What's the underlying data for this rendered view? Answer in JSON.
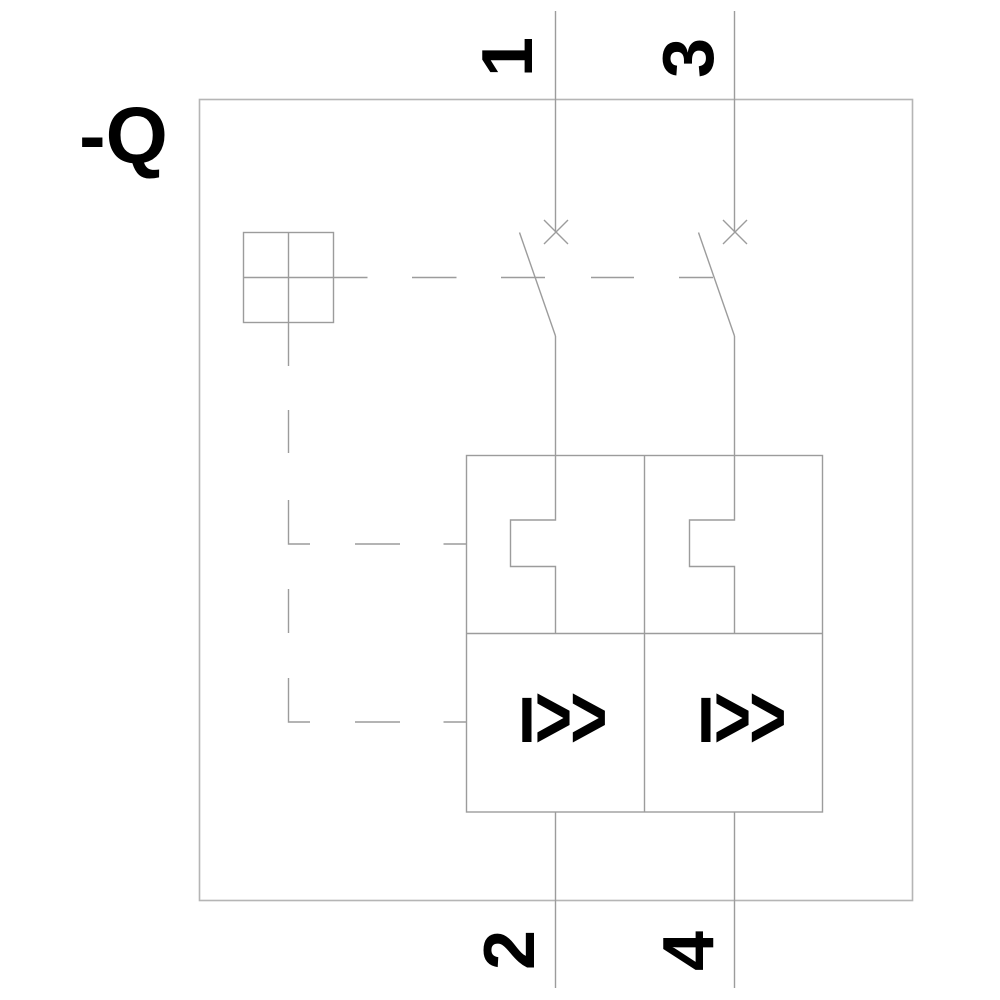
{
  "diagram": {
    "device_label": "-Q",
    "top_terminals": [
      {
        "label": "1"
      },
      {
        "label": "3"
      }
    ],
    "bottom_terminals": [
      {
        "label": "2"
      },
      {
        "label": "4"
      }
    ],
    "trip_units": [
      {
        "bar": "I",
        "chevrons": ">>"
      },
      {
        "bar": "I",
        "chevrons": ">>"
      }
    ],
    "colors": {
      "line": "#9c9c9c",
      "frame": "#b5b5b5",
      "text": "#000000",
      "background": "#ffffff"
    }
  }
}
